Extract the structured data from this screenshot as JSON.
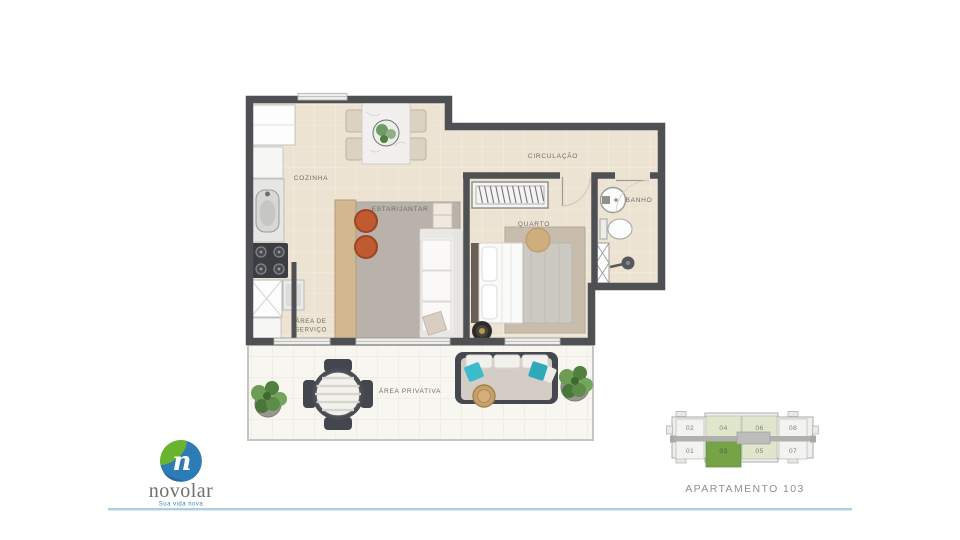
{
  "plan": {
    "rooms": {
      "cozinha": "COZINHA",
      "estar_jantar": "ESTAR/JANTAR",
      "circulacao": "CIRCULAÇÃO",
      "quarto": "QUARTO",
      "banho": "BANHO",
      "area_servico_line1": "ÁREA DE",
      "area_servico_line2": "SERVIÇO",
      "area_privativa": "ÁREA PRIVATIVA"
    },
    "colors": {
      "floor": "#ece3d2",
      "terrace_floor": "#f7f6f1",
      "wall": "#4f5054",
      "rug": "#b8b2aa",
      "accent_teal": "#3bbcca",
      "accent_terracotta": "#c05a31"
    }
  },
  "keyplan": {
    "caption": "APARTAMENTO 103",
    "highlighted_unit": "03",
    "units": [
      {
        "label": "02",
        "state": "normal"
      },
      {
        "label": "04",
        "state": "mirror"
      },
      {
        "label": "06",
        "state": "mirror"
      },
      {
        "label": "08",
        "state": "normal"
      },
      {
        "label": "01",
        "state": "normal"
      },
      {
        "label": "03",
        "state": "selected"
      },
      {
        "label": "05",
        "state": "mirror"
      },
      {
        "label": "07",
        "state": "normal"
      }
    ],
    "colors": {
      "selected": "#76a348",
      "mirror": "#e0e6cc",
      "normal": "#f3f3f1"
    }
  },
  "brand": {
    "name": "novolar",
    "tagline": "Sua vida nova",
    "monogram": "n",
    "blue": "#2d7cb5",
    "green": "#6ab32e",
    "divider_blue": "#abd0e2"
  }
}
